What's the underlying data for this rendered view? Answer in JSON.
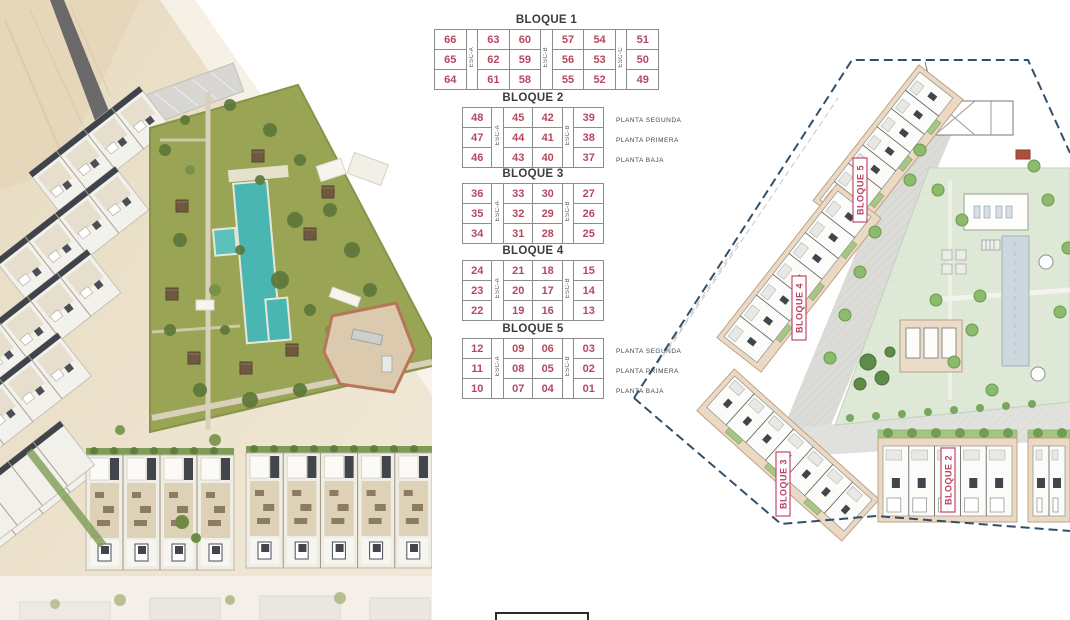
{
  "colors": {
    "unit_number": "#b5485f",
    "plan_label": "#bb3f62",
    "table_border": "#8d8d8d",
    "boundary_navy": "#33506a",
    "plan_building_beige": "#ecd9c4",
    "plan_tree_green": "#8cbb6d",
    "courtyard_green": "#dfe9d7",
    "pool_teal": "#49b6b1",
    "grass_olive": "#99a455",
    "roof_charcoal": "#3f434a"
  },
  "tables": [
    {
      "title": "BLOQUE 1",
      "esc_labels": [
        "ESC-A",
        "ESC-B",
        "ESC-C"
      ],
      "col_groups": [
        [
          0
        ],
        [
          1,
          2
        ],
        [
          3,
          4
        ],
        [
          5
        ]
      ],
      "rows": [
        [
          "66",
          "63",
          "60",
          "57",
          "54",
          "51"
        ],
        [
          "65",
          "62",
          "59",
          "56",
          "53",
          "50"
        ],
        [
          "64",
          "61",
          "58",
          "55",
          "52",
          "49"
        ]
      ],
      "floor_labels": []
    },
    {
      "title": "BLOQUE 2",
      "esc_labels": [
        "ESC-A",
        "ESC-B"
      ],
      "col_groups": [
        [
          0
        ],
        [
          1,
          2
        ],
        [
          3
        ]
      ],
      "rows": [
        [
          "48",
          "45",
          "42",
          "39"
        ],
        [
          "47",
          "44",
          "41",
          "38"
        ],
        [
          "46",
          "43",
          "40",
          "37"
        ]
      ],
      "floor_labels": [
        "PLANTA SEGUNDA",
        "PLANTA PRIMERA",
        "PLANTA BAJA"
      ]
    },
    {
      "title": "BLOQUE 3",
      "esc_labels": [
        "ESC-A",
        "ESC-B"
      ],
      "col_groups": [
        [
          0
        ],
        [
          1,
          2
        ],
        [
          3
        ]
      ],
      "rows": [
        [
          "36",
          "33",
          "30",
          "27"
        ],
        [
          "35",
          "32",
          "29",
          "26"
        ],
        [
          "34",
          "31",
          "28",
          "25"
        ]
      ],
      "floor_labels": []
    },
    {
      "title": "BLOQUE 4",
      "esc_labels": [
        "ESC-A",
        "ESC-B"
      ],
      "col_groups": [
        [
          0
        ],
        [
          1,
          2
        ],
        [
          3
        ]
      ],
      "rows": [
        [
          "24",
          "21",
          "18",
          "15"
        ],
        [
          "23",
          "20",
          "17",
          "14"
        ],
        [
          "22",
          "19",
          "16",
          "13"
        ]
      ],
      "floor_labels": []
    },
    {
      "title": "BLOQUE 5",
      "esc_labels": [
        "ESC-A",
        "ESC-B"
      ],
      "col_groups": [
        [
          0
        ],
        [
          1,
          2
        ],
        [
          3
        ]
      ],
      "rows": [
        [
          "12",
          "09",
          "06",
          "03"
        ],
        [
          "11",
          "08",
          "05",
          "02"
        ],
        [
          "10",
          "07",
          "04",
          "01"
        ]
      ],
      "floor_labels": [
        "PLANTA SEGUNDA",
        "PLANTA PRIMERA",
        "PLANTA BAJA"
      ]
    }
  ],
  "siteplan": {
    "labels": [
      "BLOQUE 5",
      "BLOQUE 4",
      "BLOQUE 3",
      "BLOQUE 2"
    ]
  }
}
